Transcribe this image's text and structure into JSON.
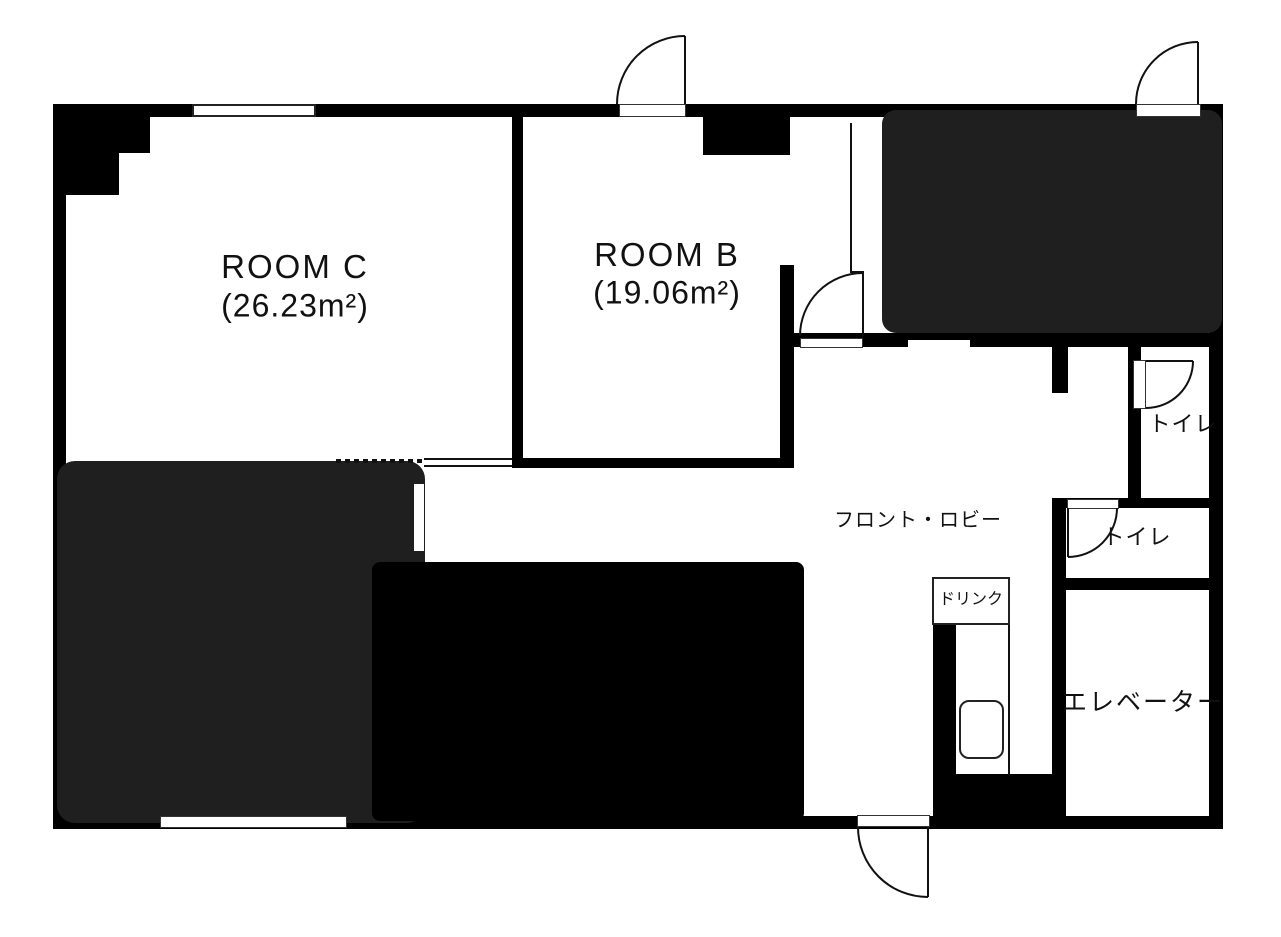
{
  "plan": {
    "type": "floor-plan",
    "rooms": {
      "room_c": {
        "label": "ROOM C",
        "area": "(26.23m²)"
      },
      "room_b": {
        "label": "ROOM B",
        "area": "(19.06m²)"
      },
      "lobby": {
        "label": "フロント・ロビー"
      },
      "toilet_upper": {
        "label": "トイレ"
      },
      "toilet_lower": {
        "label": "トイレ"
      },
      "elevator": {
        "label": "エレベーター"
      },
      "drink_corner": {
        "label": "ドリンク"
      }
    },
    "colors": {
      "wall": "#000000",
      "shaded_room": "#1f1f1f",
      "blocked_area": "#000000",
      "background": "#ffffff"
    }
  }
}
